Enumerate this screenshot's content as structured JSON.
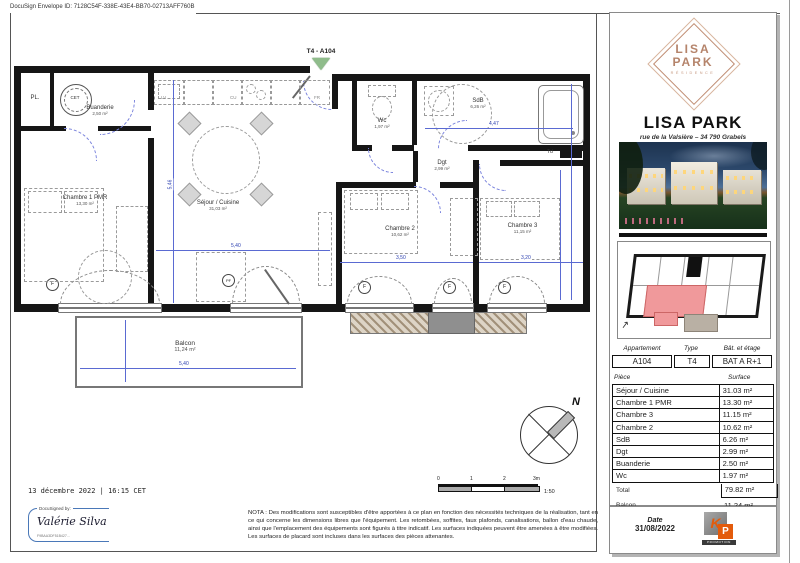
{
  "page": {
    "docusign_envelope": "DocuSign Envelope ID: 7128C54F-338E-43E4-BB70-02713AFF760B",
    "signed_date_line": "13 décembre 2022 | 16:15 CET",
    "signature": {
      "signed_by_label": "DocuSigned by:",
      "signer_name": "Valérie Silva",
      "signature_id": "F9BAA3DF51B427..."
    },
    "nota": "NOTA : Des modifications sont susceptibles d'être apportées à ce plan en fonction des nécessités techniques de la réalisation, tant en ce qui concerne les dimensions libres que l'équipement. Les retombées, soffites, faux plafonds, canalisations, ballon d'eau chaude, ainsi que l'emplacement des équipements sont figurés à titre indicatif. Les surfaces indiquées peuvent être amenées à être modifiées. Les surfaces de placard sont incluses dans les surfaces des pièces attenantes.",
    "scale": {
      "ticks": [
        "0",
        "1",
        "2",
        "3m"
      ],
      "ratio": "1:50"
    },
    "compass_label": "N"
  },
  "plan": {
    "entrance_marker": "T4 - A104",
    "rooms": [
      {
        "name": "PL.",
        "area": ""
      },
      {
        "name": "Buanderie",
        "area": "2,50 m²"
      },
      {
        "name": "Chambre 1 PMR",
        "area": "13,30 m²"
      },
      {
        "name": "Séjour / Cuisine",
        "area": "31,03 m²"
      },
      {
        "name": "Wc",
        "area": "1,97 m²"
      },
      {
        "name": "SdB",
        "area": "6,26 m²"
      },
      {
        "name": "Dgt",
        "area": "2,99 m²"
      },
      {
        "name": "Chambre 2",
        "area": "10,62 m²"
      },
      {
        "name": "Chambre 3",
        "area": "11,15 m²"
      },
      {
        "name": "Balcon",
        "area": "11,24 m²"
      }
    ],
    "kitchen_labels": {
      "lv": "LV",
      "cu": "CU",
      "fr": "FR"
    },
    "equipment": {
      "water_heater": "CET",
      "td": "Td"
    },
    "window_f": "F",
    "window_pf": "PF",
    "dimensions": {
      "sejour_w": "5,40",
      "sejour_h": "5,46",
      "sdb_w": "4,47",
      "ch2_w": "3,50",
      "ch3_w": "3,20",
      "balcon_w": "5,40"
    }
  },
  "panel": {
    "logo": {
      "line1": "LISA",
      "line2": "PARK",
      "line3": "RÉSIDENCE"
    },
    "title": "LISA PARK",
    "address": "rue de la Valsière – 34 790 Grabels",
    "apartment_table": {
      "headers": [
        "Appartement",
        "Type",
        "Bât. et étage"
      ],
      "values": [
        "A104",
        "T4",
        "BAT A R+1"
      ]
    },
    "surface_table": {
      "headers": {
        "piece": "Pièce",
        "surface": "Surface"
      },
      "rows": [
        {
          "piece": "Séjour / Cuisine",
          "surface": "31.03 m²"
        },
        {
          "piece": "Chambre 1 PMR",
          "surface": "13.30 m²"
        },
        {
          "piece": "Chambre 3",
          "surface": "11.15 m²"
        },
        {
          "piece": "Chambre 2",
          "surface": "10.62 m²"
        },
        {
          "piece": "SdB",
          "surface": "6.26 m²"
        },
        {
          "piece": "Dgt",
          "surface": "2.99 m²"
        },
        {
          "piece": "Buanderie",
          "surface": "2.50 m²"
        },
        {
          "piece": "Wc",
          "surface": "1.97 m²"
        }
      ],
      "total": {
        "label": "Total",
        "value": "79.82 m²"
      },
      "balcon": {
        "label": "Balcon",
        "value": "11.24 m²"
      }
    },
    "date_label": "Date",
    "date_value": "31/08/2022",
    "kp_logo": {
      "k": "K",
      "p": "P",
      "sub": "PROMOTION"
    }
  },
  "colors": {
    "copper": "#b5846b",
    "highlight_pink": "#f0999b",
    "dim_blue": "#3b4fc0",
    "entrance_green": "#8fbc8b",
    "kp_orange": "#e35b0c",
    "signature_blue": "#4a78b8"
  }
}
